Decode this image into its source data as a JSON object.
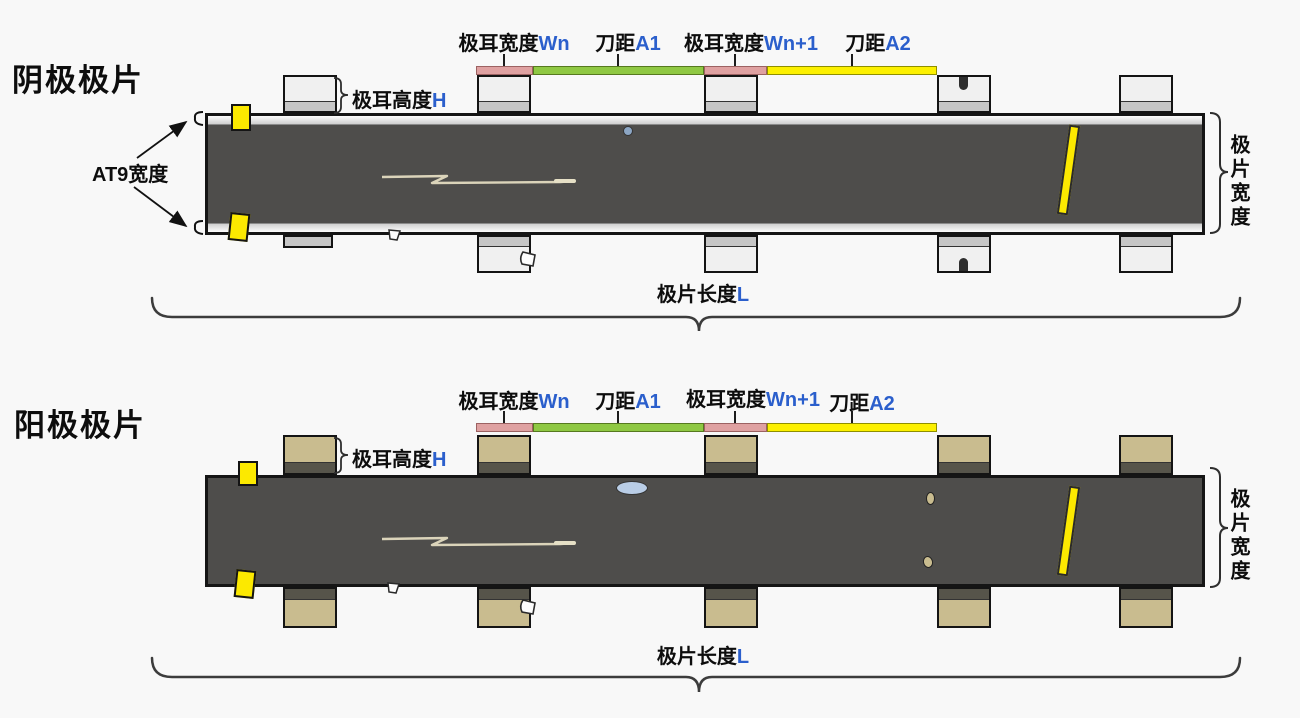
{
  "colors": {
    "accent_blue": "#2b5fcc",
    "strip": "#4e4d4b",
    "cathode_tab": "#f0f0f0",
    "cathode_band": "#c6c6c6",
    "anode_tab": "#c9bc8f",
    "anode_band": "#56544a",
    "bar_pink": "#dfa1a1",
    "bar_green": "#8fc843",
    "bar_yellow": "#fcf000",
    "marker_yellow": "#fce900"
  },
  "cathode": {
    "title": "阴极极片"
  },
  "anode": {
    "title": "阳极极片"
  },
  "dimensions": {
    "tab_width_n": {
      "text": "极耳宽度",
      "var": "Wn"
    },
    "knife_a1": {
      "text": "刀距",
      "var": "A1"
    },
    "tab_width_n1": {
      "text": "极耳宽度",
      "var": "Wn+1"
    },
    "knife_a2": {
      "text": "刀距",
      "var": "A2"
    },
    "tab_height": {
      "text": "极耳高度",
      "var": "H"
    },
    "at9_width": "AT9宽度",
    "sheet_width": "极片宽度",
    "sheet_length": {
      "text": "极片长度",
      "var": "L"
    }
  }
}
